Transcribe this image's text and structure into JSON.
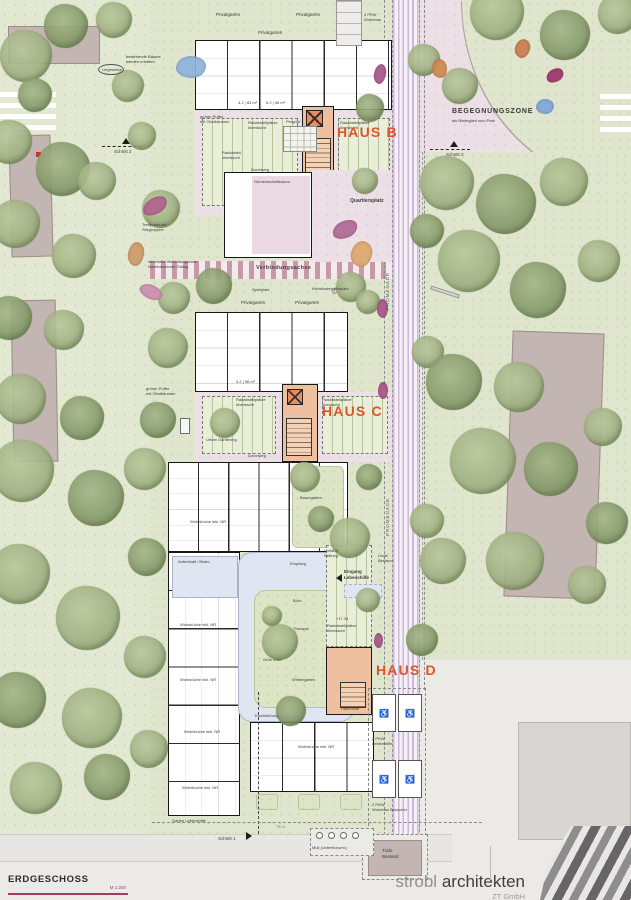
{
  "title_block": {
    "title": "ERDGESCHOSS",
    "scale": "M 1:200"
  },
  "logo": {
    "word1": "strobl",
    "word2": "architekten",
    "sub": "ZT GmbH"
  },
  "houses": {
    "b": "HAUS B",
    "c": "HAUS C",
    "d": "HAUS D"
  },
  "zones": {
    "begegnungszone": "BEGEGNUNGSZONE",
    "begegnungszone_sub": "als Bindeglied zum Park",
    "quartiersplatz": "Quartiersplatz",
    "verbindungsachse": "Verbindungsachse",
    "promenade": "PROMENADE"
  },
  "sections": {
    "schnitt1": "Schnitt 1",
    "schnitt2": "Schnitt 2"
  },
  "labels": {
    "privatgarten": "Privatgarten",
    "radabstell": "Radabstellplätze überdacht",
    "radabstell_short": "Radabstell.\nüberdacht",
    "durchweg": "Durchweg",
    "gemeinschaftsraum": "Gemeinschaftsraum",
    "wohnkueche": "Wohnküche inkl. NR",
    "aufenthalt": "Aufenthalt / Bistro",
    "empfang": "Empfang",
    "buero": "Büro",
    "therapie": "Therapie",
    "wintergarten": "Wintergarten",
    "erschliessung": "Erschließung",
    "gruen_insel": "Grün Insel",
    "rad_kiwa": "Rad/KiWa",
    "baumgarten": "Baumgarten",
    "garten_lebenshilfe": "Garten Lebenshilfe",
    "eingang_lebenshilfe": "Eingang\nLebenshilfe",
    "vorfahrt_rettung": "Vorfahrt\nRettung",
    "linde_bestand": "Linde\nBestand",
    "gruener_puffer": "grüner Puffer\nmit Obstbäumen",
    "urban_gardening": "Urban Gardening",
    "spielplatz": "Spielplatz",
    "kleinkinderspielplatz": "Kleinkinderspielplatz",
    "treffpunkt": "Treffpunkt mit\nSitzgruppen",
    "informell": "informelle Verbindungszone\nNachbarschaftl. Dialog",
    "pergola": "Pergola",
    "liegewiese": "Liegewiese",
    "baumbestand": "bestehende Bäume\nwerden erhalten",
    "pkw4": "4 PKW\nWohnbau",
    "pkw2_lh": "2 PKW\nLebenshilfe",
    "pkw2_wb": "2 PKW\nWohnbau Besucher",
    "trafo": "Trafo\nBestand",
    "muell": "Müll (Unterflurcont.)",
    "level": "+17.34",
    "area_b1": "4.2 | 83 m²",
    "area_b2": "5.2 | 96 m²",
    "area_c1": "4.2 | 96 m²",
    "dim75": "75 m"
  },
  "colors": {
    "haus_accent": "#dd5429",
    "scale_line": "#a43b67",
    "plan_green": "#dfe6cd",
    "plaza_pink": "#ecdfe6",
    "promenade_lilac": "#cdb9d8",
    "core_salmon": "#eec0a0",
    "corridor_blue": "#dfe6f1"
  }
}
